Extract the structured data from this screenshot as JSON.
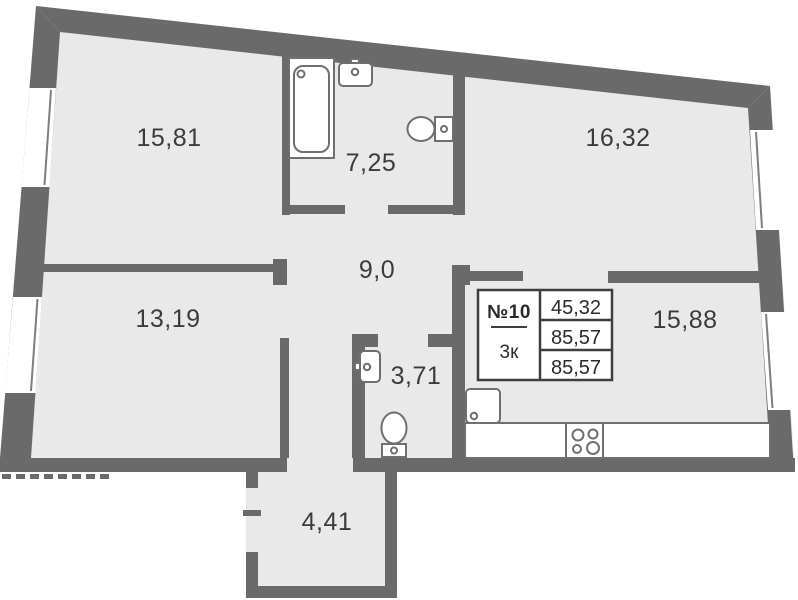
{
  "plan": {
    "type": "apartment-floor-plan",
    "unit_table": {
      "unit_number": "№10",
      "rooms_count": "3к",
      "values": [
        "45,32",
        "85,57",
        "85,57"
      ]
    },
    "rooms": [
      {
        "name": "bedroom-top-left",
        "area": "15,81"
      },
      {
        "name": "bathroom-large",
        "area": "7,25"
      },
      {
        "name": "bedroom-top-right",
        "area": "16,32"
      },
      {
        "name": "bedroom-bottom-left",
        "area": "13,19"
      },
      {
        "name": "corridor",
        "area": "9,0"
      },
      {
        "name": "bathroom-small",
        "area": "3,71"
      },
      {
        "name": "kitchen-living",
        "area": "15,88"
      },
      {
        "name": "entrance-hall",
        "area": "4,41"
      }
    ],
    "colors": {
      "wall": "#6a6a6a",
      "floor": "#e9e9e9",
      "fixture_stroke": "#6f6f6f",
      "table_border": "#3e3e3e",
      "label_text": "#3b3b3b",
      "background": "#ffffff"
    }
  }
}
